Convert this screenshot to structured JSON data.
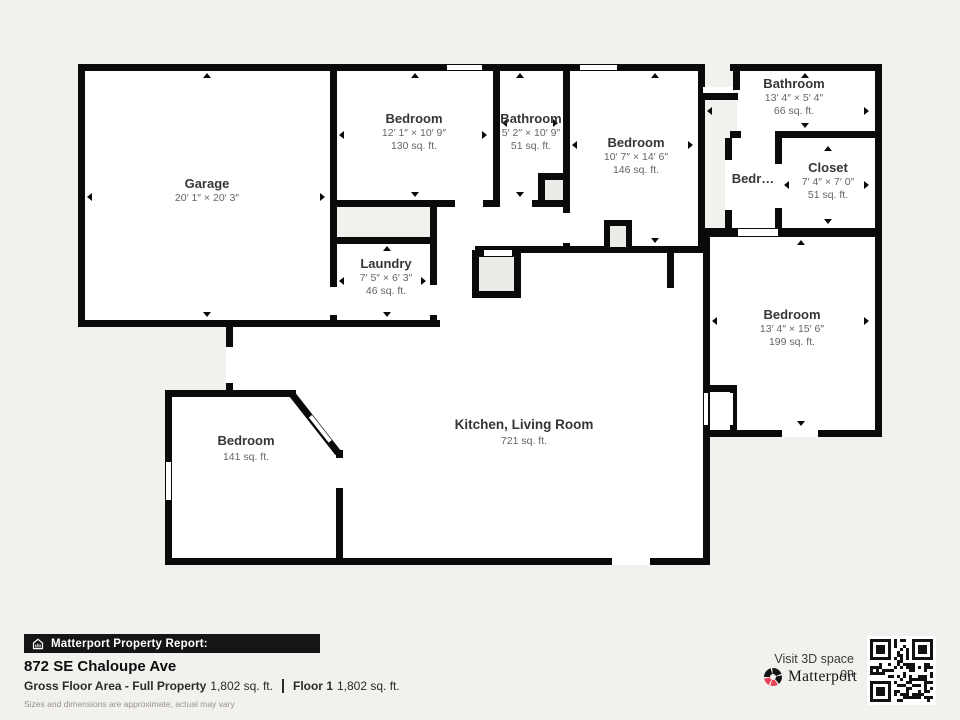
{
  "colors": {
    "wall": "#0a0a0a",
    "background": "#f2f1ee",
    "brand_red": "#e8435a"
  },
  "rooms": [
    {
      "name": "Garage",
      "dims": "20′ 1″ × 20′ 3″"
    },
    {
      "name": "Bedroom",
      "dims": "12′ 1″ × 10′ 9″",
      "area": "130 sq. ft."
    },
    {
      "name": "Bathroom",
      "dims": "5′ 2″ × 10′ 9″",
      "area": "51 sq. ft."
    },
    {
      "name": "Bedroom",
      "dims": "10′ 7″ × 14′ 6″",
      "area": "146 sq. ft."
    },
    {
      "name": "Bathroom",
      "dims": "13′ 4″ × 5′ 4″",
      "area": "66 sq. ft."
    },
    {
      "name": "Bedr…"
    },
    {
      "name": "Closet",
      "dims": "7′ 4″ × 7′ 0″",
      "area": "51 sq. ft."
    },
    {
      "name": "Bedroom",
      "dims": "13′ 4″ × 15′ 6″",
      "area": "199 sq. ft."
    },
    {
      "name": "Laundry",
      "dims": "7′ 5″ × 6′ 3″",
      "area": "46 sq. ft."
    },
    {
      "name": "Bedroom",
      "area": "141 sq. ft."
    },
    {
      "name": "Kitchen, Living Room",
      "area": "721 sq. ft."
    }
  ],
  "footer": {
    "report_label": "Matterport Property Report:",
    "address": "872 SE Chaloupe Ave",
    "gross_label": "Gross Floor Area - Full Property",
    "gross_value": "1,802 sq. ft.",
    "floor_label": "Floor 1",
    "floor_value": "1,802 sq. ft.",
    "disclaimer": "Sizes and dimensions are approximate, actual may vary",
    "visit_text": "Visit 3D space on",
    "brand": "Matterport"
  }
}
